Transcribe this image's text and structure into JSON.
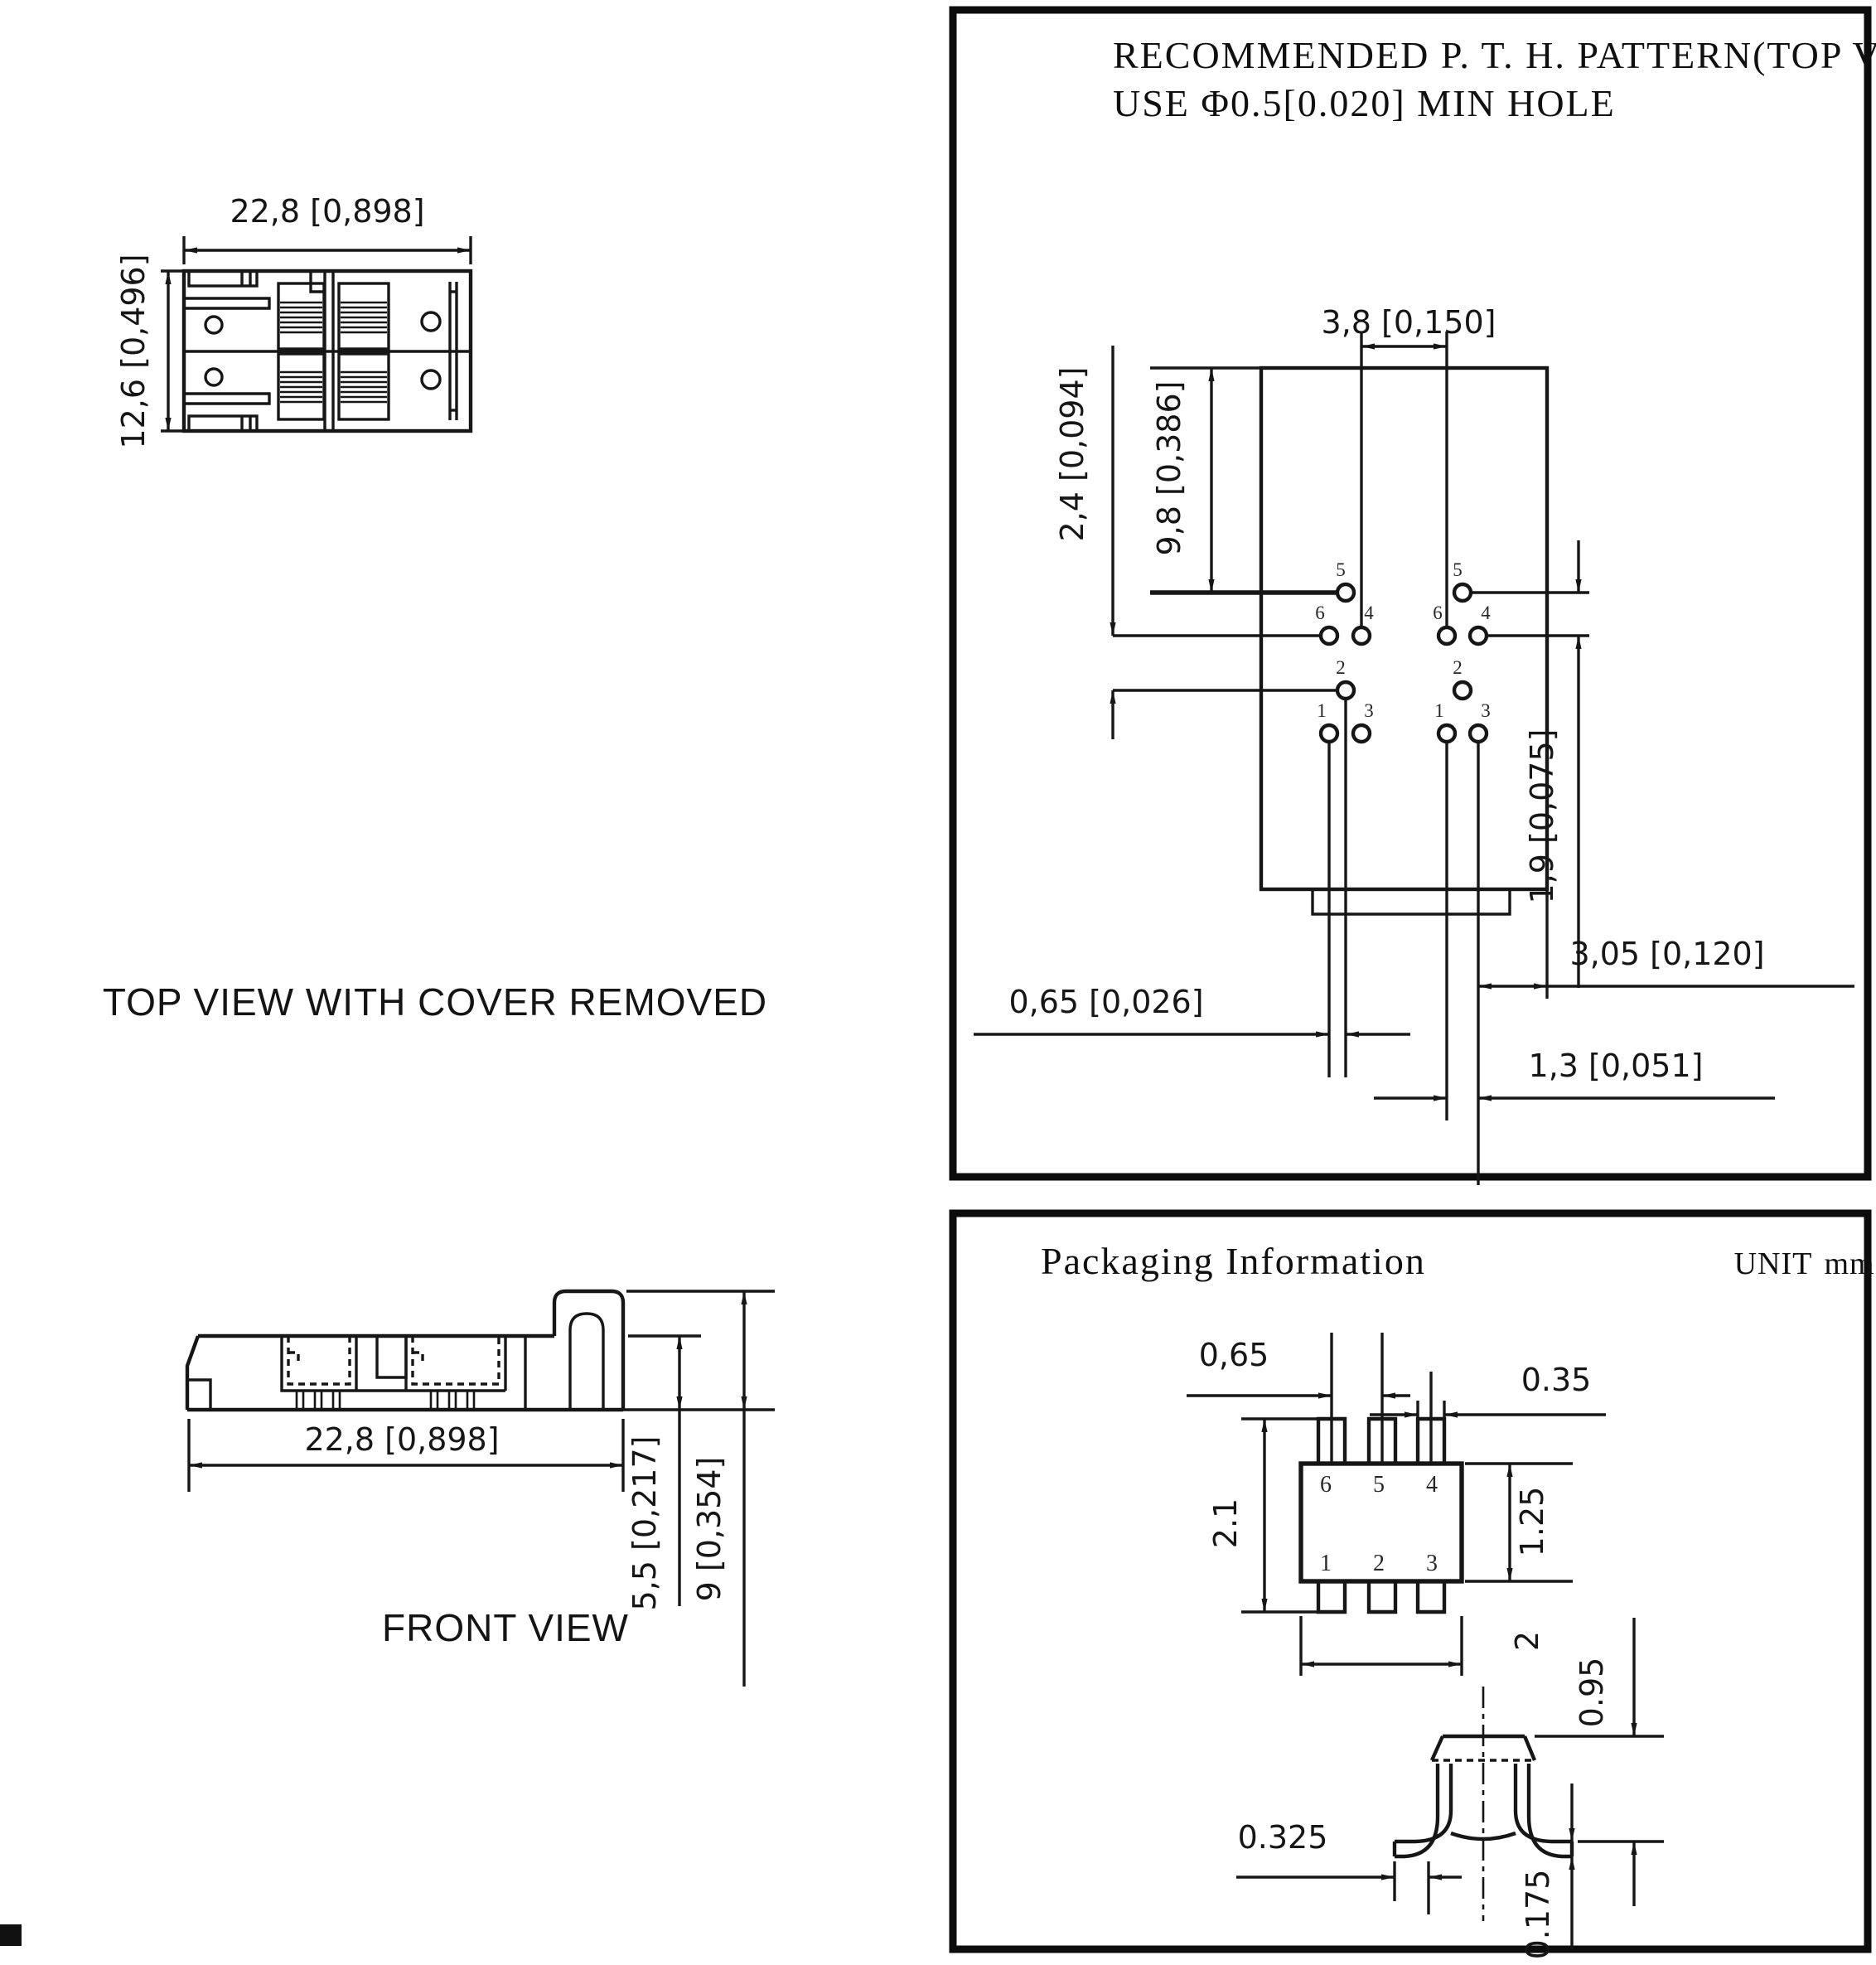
{
  "top_view": {
    "caption": "TOP VIEW WITH COVER REMOVED",
    "dim_width": "22,8 [0,898]",
    "dim_height": "12,6 [0,496]"
  },
  "front_view": {
    "caption": "FRONT VIEW",
    "dim_width": "22,8 [0,898]",
    "dim_body_height": "5,5 [0,217]",
    "dim_total_height": "9 [0,354]"
  },
  "pth_panel": {
    "title_line1": "RECOMMENDED P. T. H.  PATTERN(TOP VIEW)",
    "title_line2": "USE  Φ0.5[0.020]  MIN HOLE",
    "dims": {
      "pitch_x": "3,8  [0,150]",
      "offset_top": "2,4  [0,094]",
      "body_height": "9,8  [0,386]",
      "row_gap": "1,9  [0,075]",
      "col_gap_left": "0,65  [0,026]",
      "col_gap_right": "1,3  [0,051]",
      "edge_gap": "3,05  [0,120]"
    },
    "pin_labels_left": [
      "5",
      "6",
      "4",
      "2",
      "1",
      "3"
    ],
    "pin_labels_right": [
      "5",
      "6",
      "4",
      "2",
      "1",
      "3"
    ]
  },
  "packaging": {
    "title": "Packaging Information",
    "unit_label": "UNIT",
    "unit_value": "mm",
    "dims": {
      "pin_pitch": "0,65",
      "pin_width": "0.35",
      "total_height": "2.1",
      "body_height": "1.25",
      "body_width": "2",
      "pkg_height": "0.95",
      "foot_length": "0.325",
      "lead_thickness": "0.175"
    },
    "pins_top": [
      "6",
      "5",
      "4"
    ],
    "pins_bottom": [
      "1",
      "2",
      "3"
    ]
  }
}
